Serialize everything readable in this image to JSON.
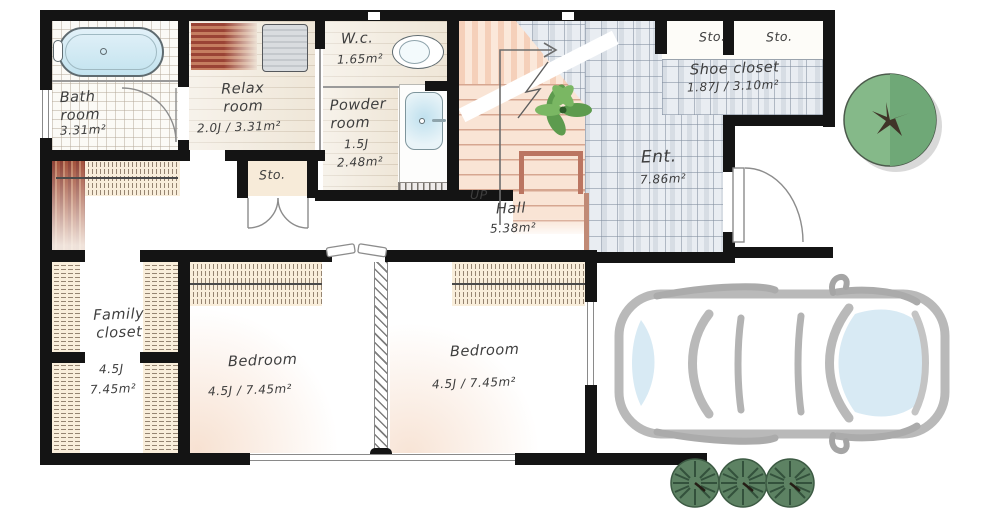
{
  "rooms": {
    "bath": {
      "label": "Bath room",
      "area": "3.31m²"
    },
    "relax": {
      "label": "Relax room",
      "area": "2.0J / 3.31m²"
    },
    "wc": {
      "label": "W.c.",
      "area": "1.65m²"
    },
    "powder": {
      "label": "Powder room",
      "area_jo": "1.5J",
      "area_sqm": "2.48m²"
    },
    "storage_wet": {
      "label": "Sto."
    },
    "hall": {
      "label": "Hall",
      "area": "5.38m²"
    },
    "stairs": {
      "label": "UP"
    },
    "entrance": {
      "label": "Ent.",
      "area": "7.86m²"
    },
    "shoe_closet": {
      "label": "Shoe closet",
      "area": "1.87J / 3.10m²"
    },
    "storage_left": {
      "label": "Sto."
    },
    "storage_right": {
      "label": "Sto."
    },
    "family_closet": {
      "label": "Family closet",
      "area_jo": "4.5J",
      "area_sqm": "7.45m²"
    },
    "bedroom_west": {
      "label": "Bedroom",
      "area": "4.5J / 7.45m²"
    },
    "bedroom_east": {
      "label": "Bedroom",
      "area": "4.5J / 7.45m²"
    }
  },
  "colors": {
    "wall": "#141414",
    "entrance_tile": "#e9edf2",
    "stair": "#f6d8c2",
    "wood_floor": "#f0e8da",
    "tree_green": "#7fb382",
    "car_outline": "#b9b9b9"
  }
}
